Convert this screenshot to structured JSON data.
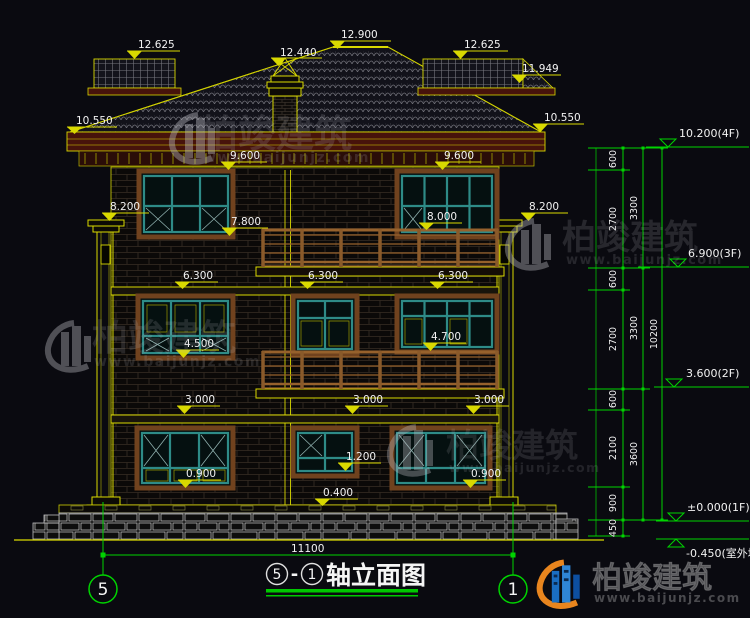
{
  "drawing": {
    "title": "轴立面图",
    "title_dash": "-",
    "axis_left": "5",
    "axis_right": "1",
    "total_width_mm": "11100"
  },
  "roof_marks": {
    "wing_left": "12.625",
    "ridge": "12.900",
    "chimney": "12.440",
    "wing_right": "12.625",
    "right_edge": "11.949",
    "eave_left": "10.550",
    "eave_right": "10.550"
  },
  "f3_marks": {
    "win_left_head": "9.600",
    "win_right_head": "9.600",
    "pilaster_left": "8.200",
    "pilaster_right": "8.200",
    "rail_top": "8.000",
    "win_left_sill": "7.800",
    "band": "6.300"
  },
  "f2_marks": {
    "win_left_sill": "4.500",
    "win_right_sill": "4.700",
    "band": "3.000"
  },
  "f1_marks": {
    "win_left_sill": "0.900",
    "win_center_sill": "1.200",
    "win_right_sill": "0.900",
    "plinth": "0.400"
  },
  "right_dims": {
    "seg_600a": "600",
    "seg_2700a": "2700",
    "seg_600b": "600",
    "seg_2700b": "2700",
    "seg_600c": "600",
    "seg_2100": "2100",
    "seg_900": "900",
    "seg_450": "450",
    "sub_3300a": "3300",
    "sub_3300b": "3300",
    "sub_3600": "3600",
    "overall": "10200",
    "level_4f": "10.200(4F)",
    "level_3f": "6.900(3F)",
    "level_2f": "3.600(2F)",
    "level_1f": "±0.000(1F)",
    "level_ground": "-0.450(室外地坪)"
  },
  "watermark": {
    "brand": "柏竣建筑",
    "url": "www.baijunjz.com"
  },
  "colors": {
    "background": "#0a0a10",
    "line_yellow": "#d9d900",
    "dim_green": "#00d400",
    "text_white": "#f2f2f2",
    "window_teal": "#2e8b87",
    "trim_brown": "#8a5a2a",
    "cornice_red": "#47130b",
    "logo_blue": "#1a6ec2",
    "logo_orange": "#e8851e"
  }
}
